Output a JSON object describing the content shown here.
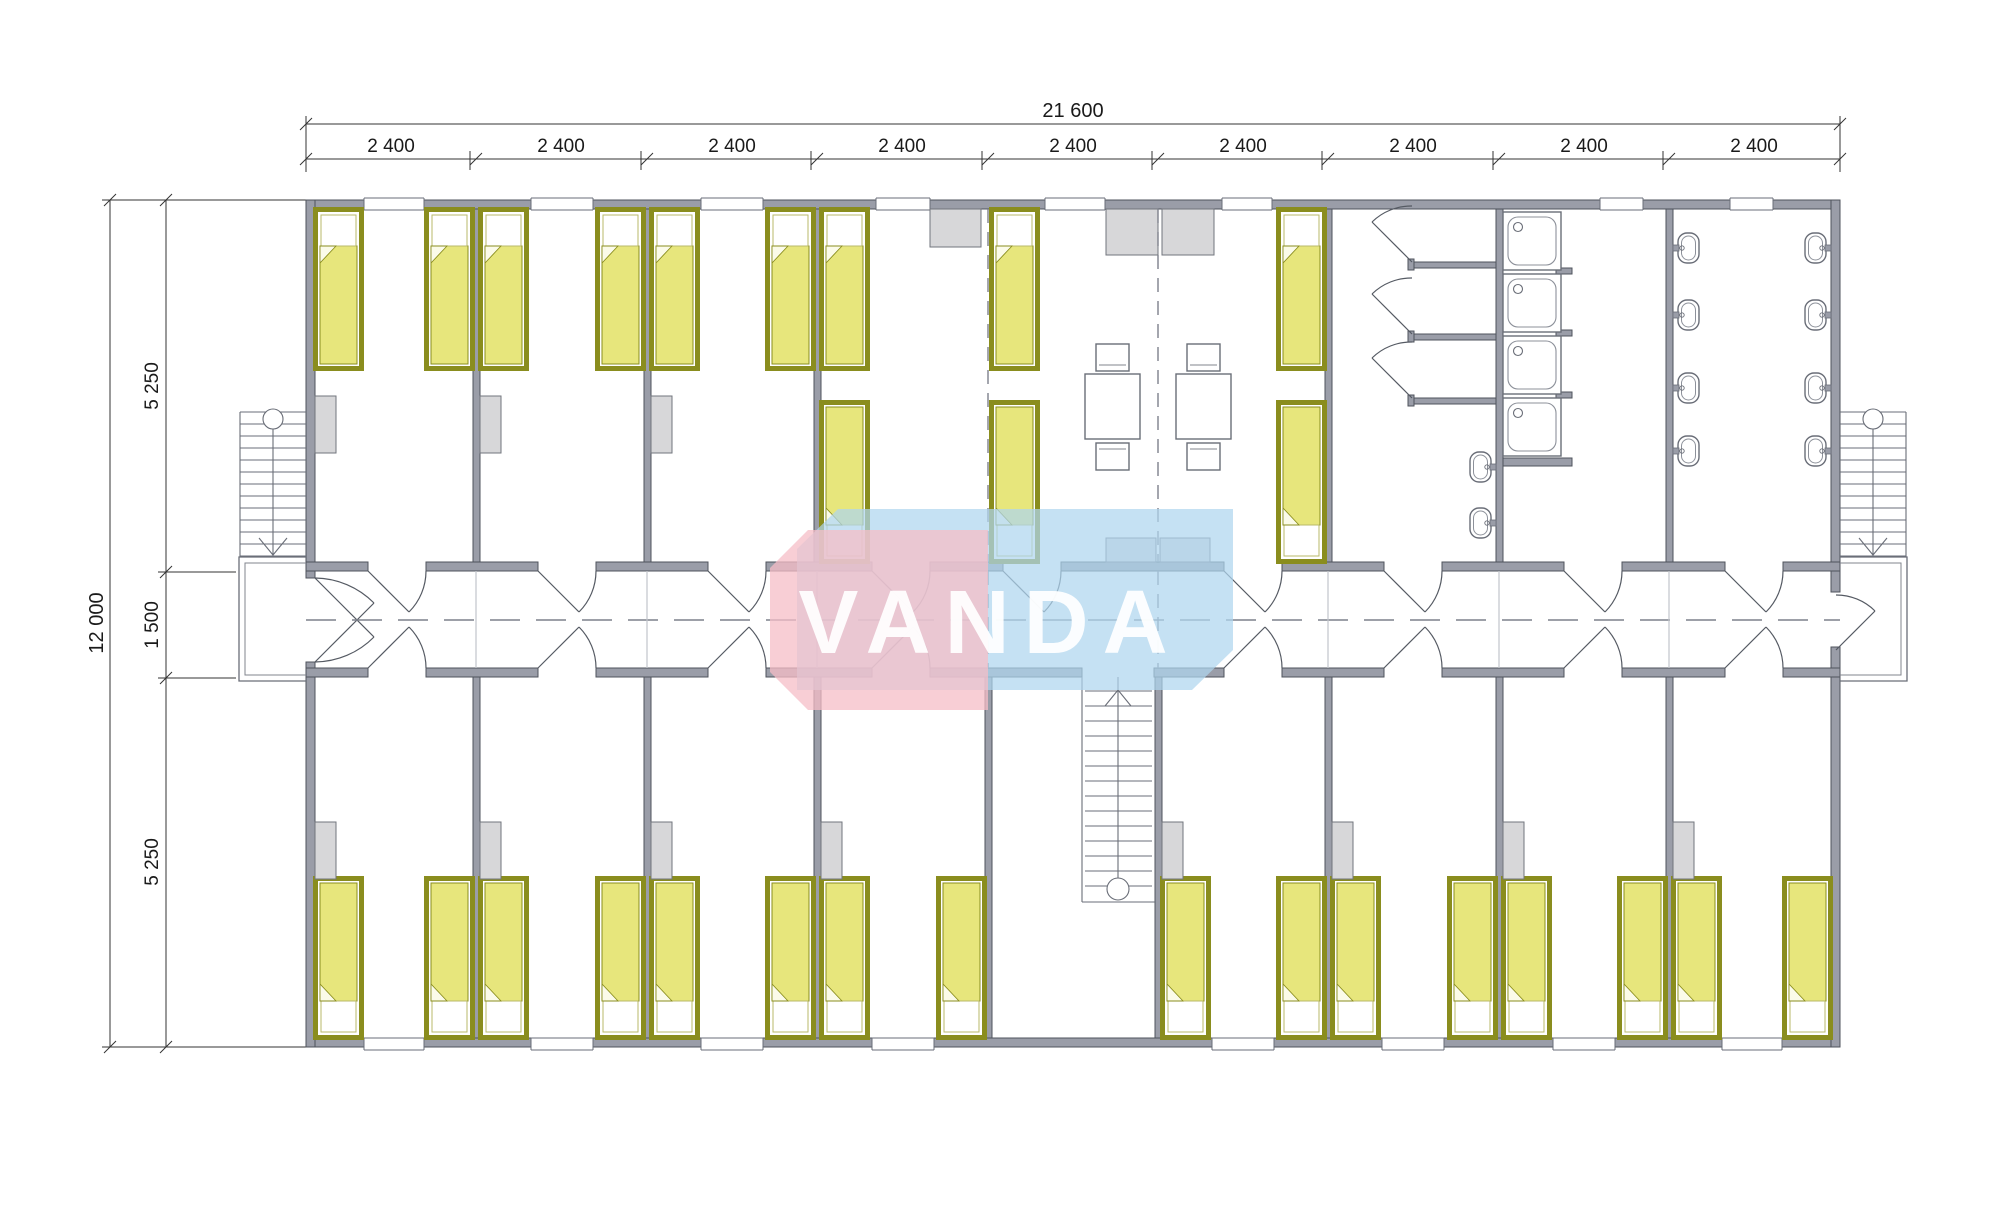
{
  "drawing": {
    "type": "modular dormitory floor plan",
    "units": "mm",
    "dimensions": {
      "total_width": "21 600",
      "module_width": "2 400",
      "module_count": 9,
      "total_depth": "12 000",
      "upper_rooms_depth": "5 250",
      "corridor_depth": "1 500",
      "lower_rooms_depth": "5 250"
    },
    "watermark": {
      "text": "VANDA",
      "blue": "#aed5ef",
      "pink": "#f5bdc7"
    },
    "palette": {
      "wall": "#9a9da8",
      "wall_edge": "#4f535c",
      "bed_frame": "#8a8d1e",
      "bed_blanket": "#e7e67c",
      "furniture_gray": "#d7d7d9",
      "line": "#6a6e78"
    },
    "fixtures": {
      "single_beds": 28,
      "wardrobes": 11,
      "cabinets": 5,
      "dining_tables": 2,
      "stools": 4,
      "toilet_stalls": 3,
      "shower_trays": 4,
      "washbasins": 10,
      "staircases": 3,
      "entrance_landings": 2
    }
  }
}
